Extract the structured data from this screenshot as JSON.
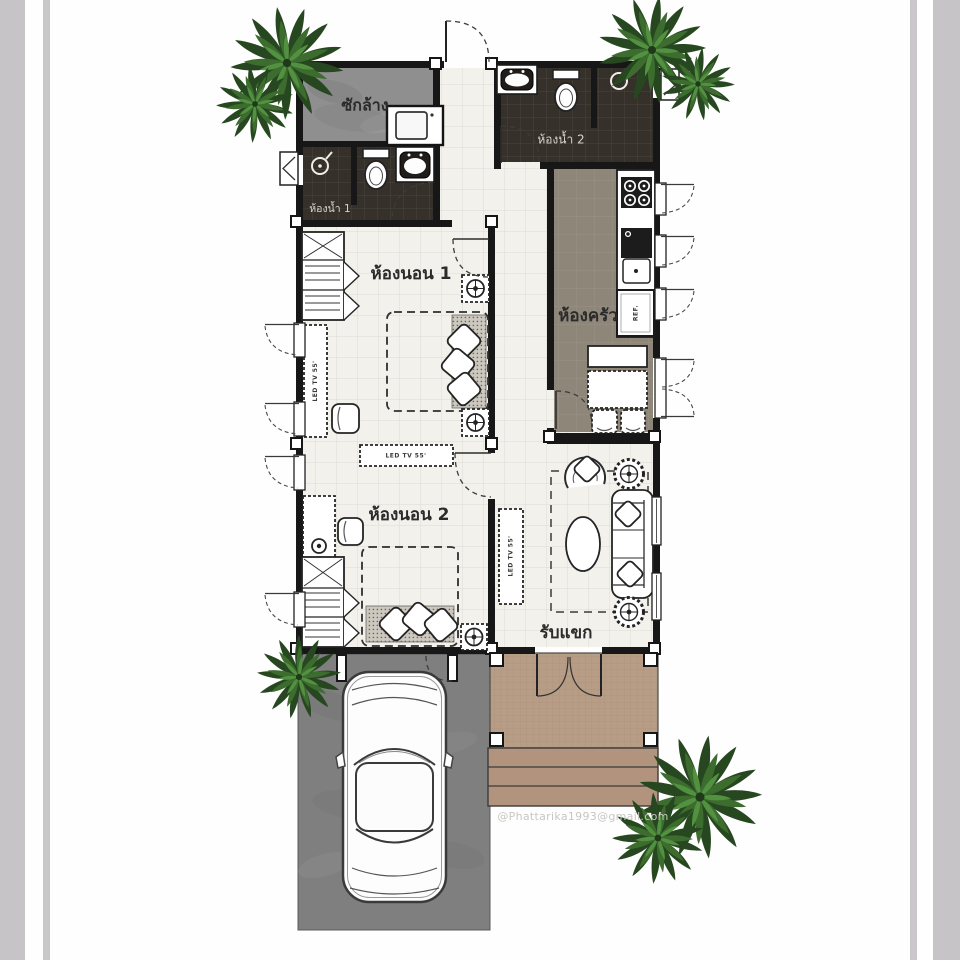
{
  "plan": {
    "rooms": {
      "laundry": {
        "label": "ซักล้าง"
      },
      "bathroom1": {
        "label": "ห้องน้ำ 1"
      },
      "bathroom2": {
        "label": "ห้องน้ำ 2"
      },
      "bedroom1": {
        "label": "ห้องนอน 1"
      },
      "bedroom2": {
        "label": "ห้องนอน 2"
      },
      "kitchen": {
        "label": "ห้องครัว"
      },
      "living": {
        "label": "รับแขก"
      }
    },
    "furniture_labels": {
      "tv_bedroom1": "LED TV 55'",
      "tv_bedroom2": "LED TV 55'",
      "tv_living": "LED TV 55'",
      "fridge": "REF."
    },
    "watermark": "@Phattarika1993@gmail.com",
    "colors": {
      "wall": "#171717",
      "tile_light": "#f2f1ec",
      "tile_light_line": "#dedbd3",
      "tile_dark": "#353029",
      "tile_dark_line": "#4b4540",
      "kitchen_floor": "#8e8679",
      "kitchen_floor_line": "#999184",
      "laundry_concrete": "#8f8f8f",
      "garage_concrete": "#7f7f7f",
      "porch": "#b79c86",
      "porch_line": "#aa8f79",
      "steps": "#b2947e",
      "frame_bar": "#c6c4c7",
      "tree_dark": "#26471f",
      "tree_mid": "#3c6c2e",
      "tree_light": "#529140",
      "watermark_gray": "#c9c6c2"
    }
  }
}
